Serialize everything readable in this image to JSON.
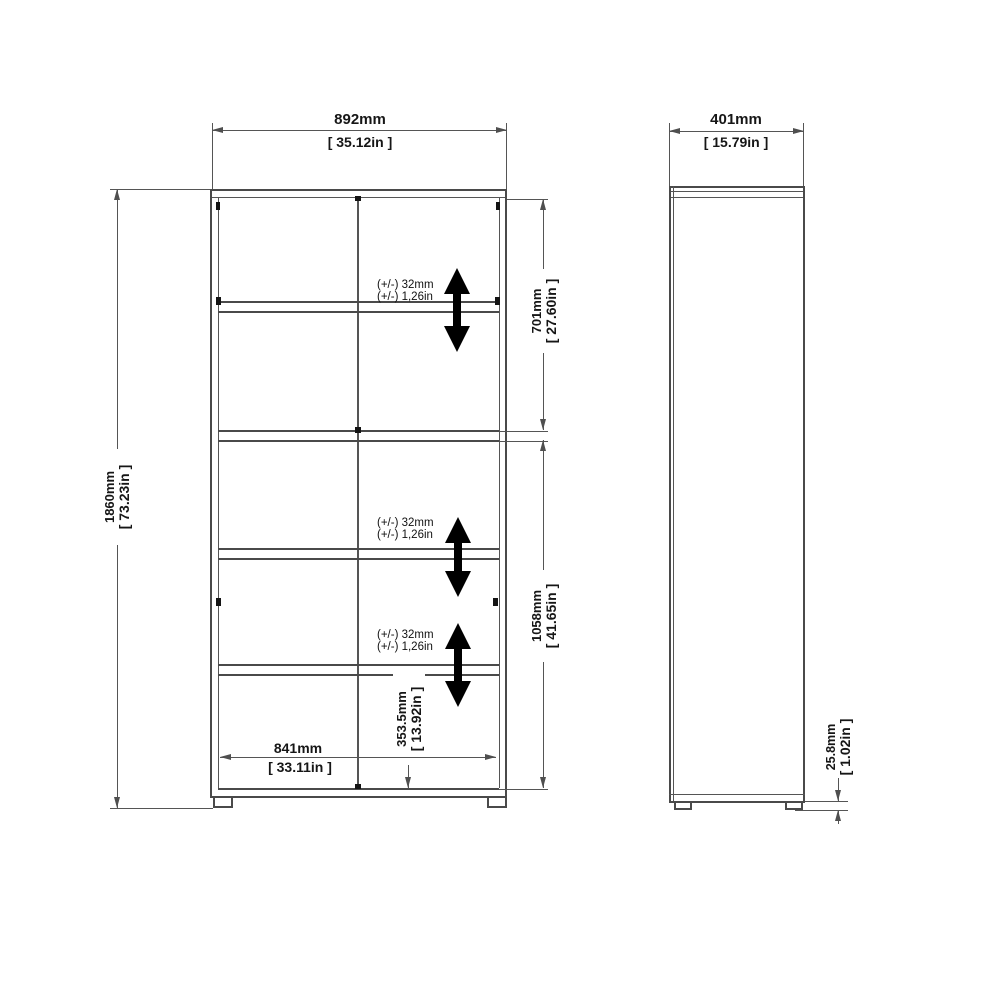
{
  "front": {
    "width_mm": "892mm",
    "width_in": "[ 35.12in ]",
    "height_mm": "1860mm",
    "height_in": "[ 73.23in ]",
    "upper_mm": "701mm",
    "upper_in": "[ 27.60in ]",
    "lower_mm": "1058mm",
    "lower_in": "[ 41.65in ]",
    "bottom_mm": "353.5mm",
    "bottom_in": "[ 13.92in ]",
    "inner_width_mm": "841mm",
    "inner_width_in": "[ 33.11in ]"
  },
  "side": {
    "depth_mm": "401mm",
    "depth_in": "[ 15.79in ]",
    "foot_mm": "25.8mm",
    "foot_in": "[ 1.02in ]"
  },
  "shelf_adjustment": {
    "mm": "(+/-) 32mm",
    "inch": "(+/-) 1,26in"
  }
}
